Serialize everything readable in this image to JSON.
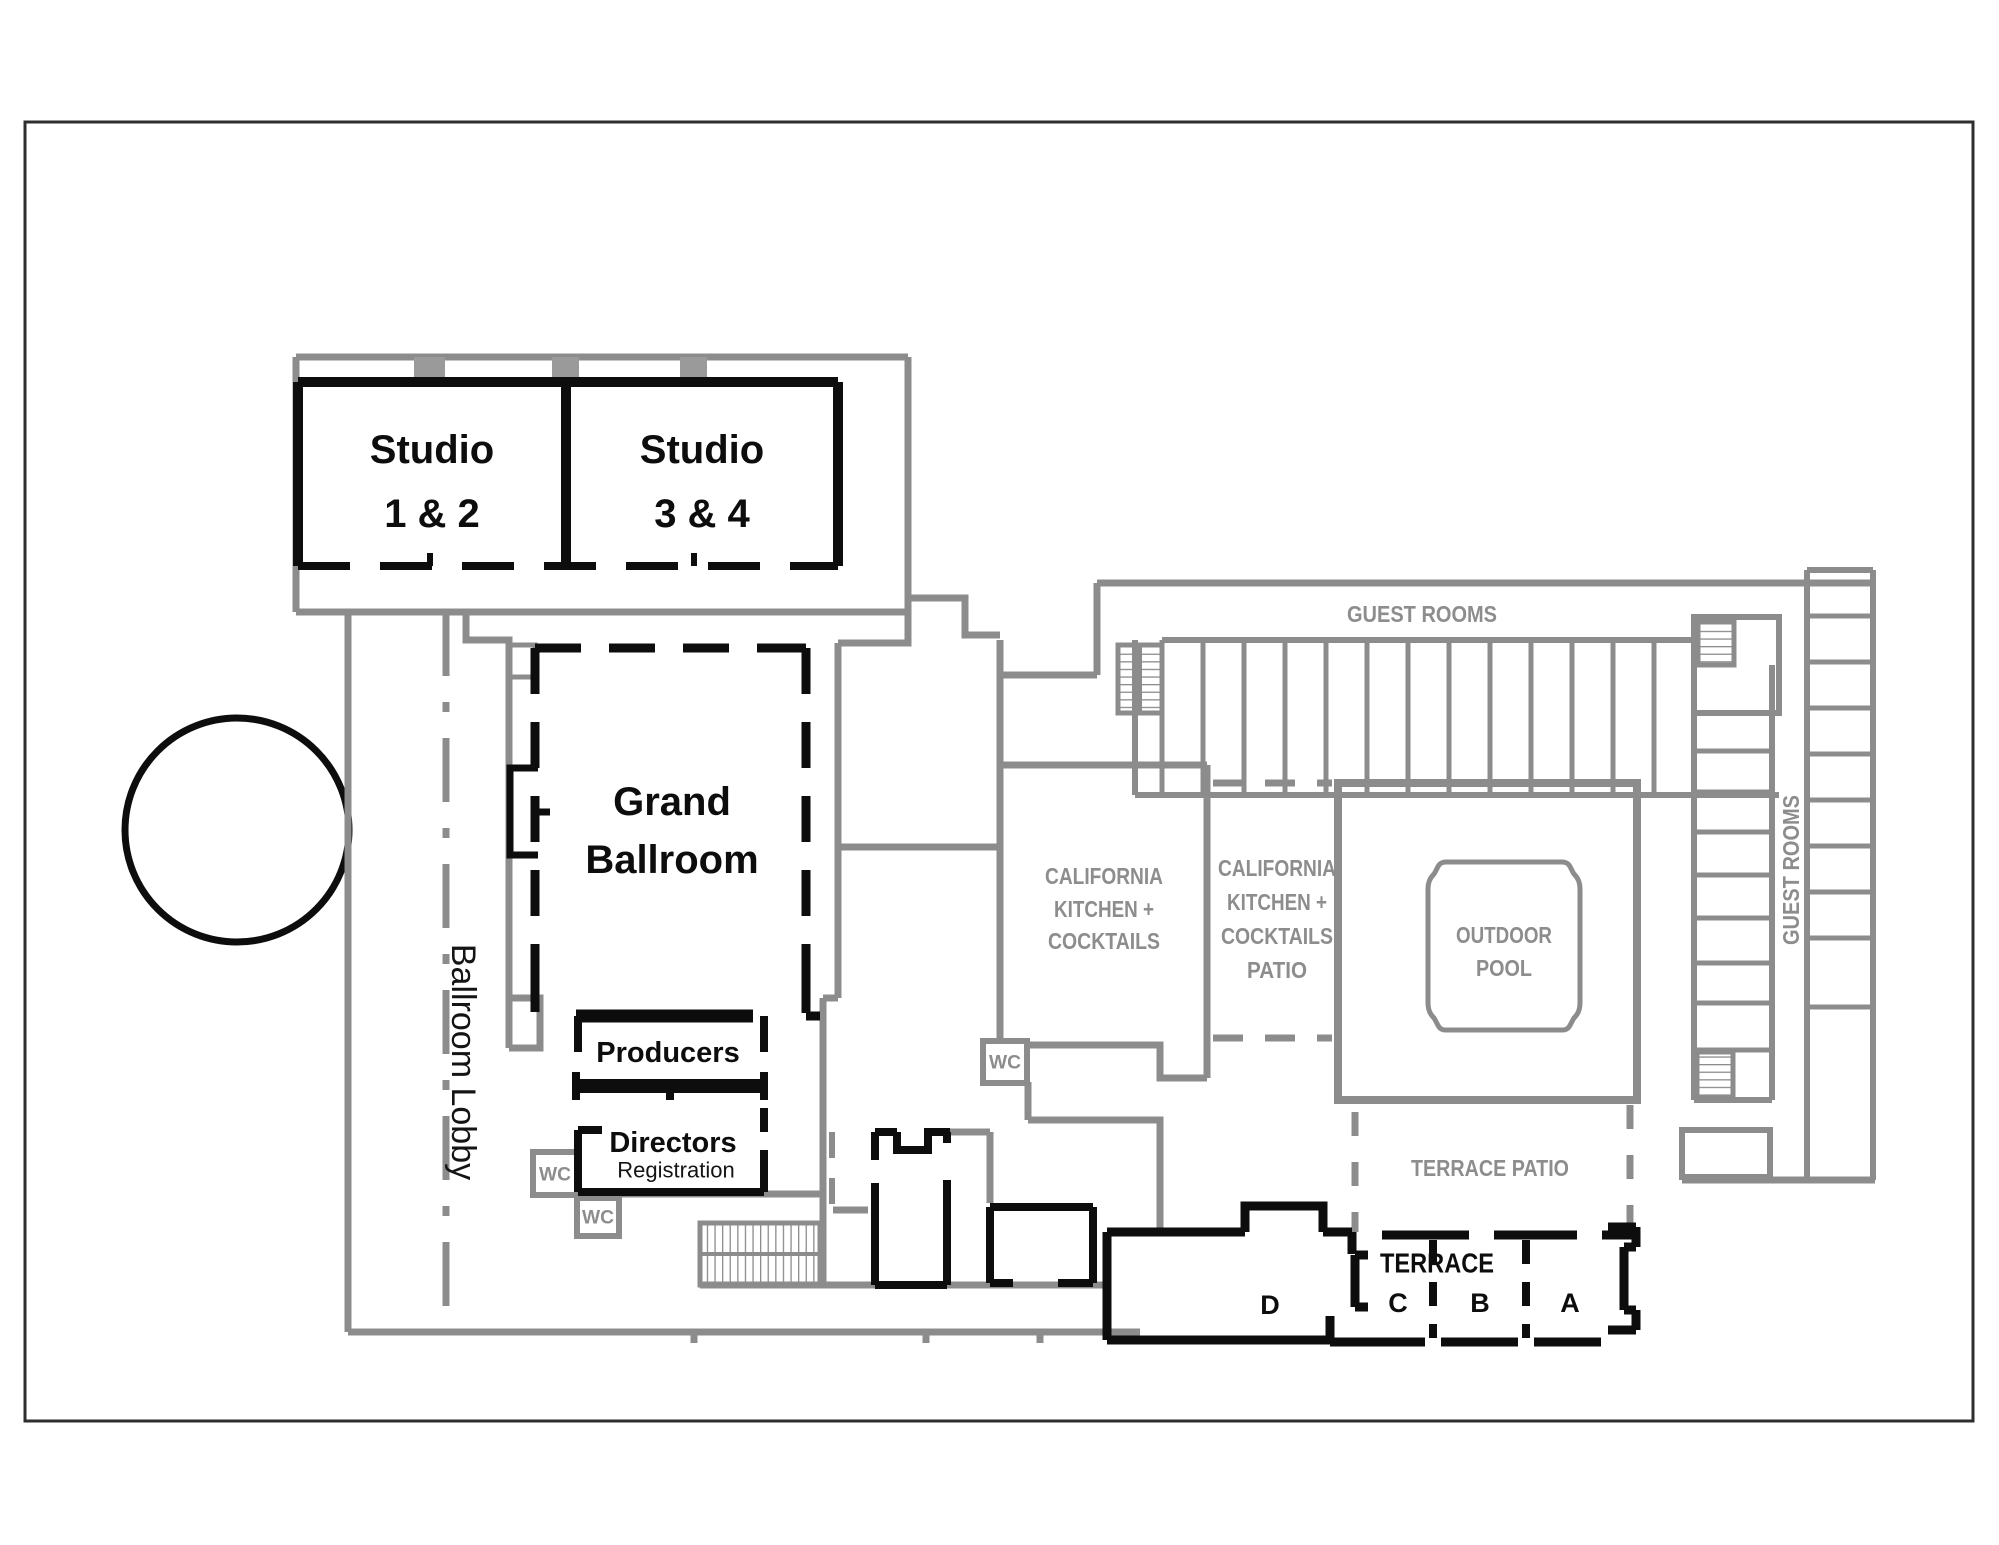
{
  "colors": {
    "wall_black": "#0d0d0d",
    "wall_gray": "#8c8c8c",
    "label_gray": "#8d8d8d",
    "background": "#ffffff"
  },
  "rooms": {
    "studio_1_2": {
      "line1": "Studio",
      "line2": "1 & 2"
    },
    "studio_3_4": {
      "line1": "Studio",
      "line2": "3 & 4"
    },
    "grand_ballroom": {
      "line1": "Grand",
      "line2": "Ballroom"
    },
    "ballroom_lobby": {
      "label": "Ballroom Lobby"
    },
    "producers": {
      "label": "Producers"
    },
    "directors": {
      "label": "Directors",
      "sublabel": "Registration"
    },
    "wc": {
      "label": "WC"
    },
    "california_kitchen_cocktails": {
      "line1": "CALIFORNIA",
      "line2": "KITCHEN +",
      "line3": "COCKTAILS"
    },
    "california_kitchen_cocktails_patio": {
      "line1": "CALIFORNIA",
      "line2": "KITCHEN +",
      "line3": "COCKTAILS",
      "line4": "PATIO"
    },
    "outdoor_pool": {
      "line1": "OUTDOOR",
      "line2": "POOL"
    },
    "guest_rooms": {
      "label": "GUEST ROOMS"
    },
    "terrace_patio": {
      "label": "TERRACE PATIO"
    },
    "terrace": {
      "label": "TERRACE",
      "section_a": "A",
      "section_b": "B",
      "section_c": "C",
      "section_d": "D"
    }
  }
}
